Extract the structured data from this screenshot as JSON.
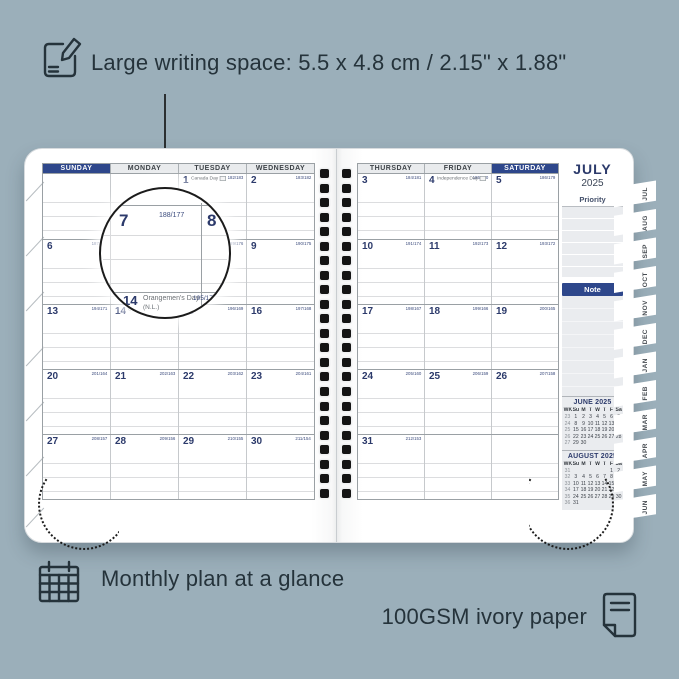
{
  "annotations": {
    "writing_space": {
      "icon": "pencil-note-icon",
      "text": "Large writing space: 5.5 x 4.8 cm / 2.15\" x 1.88\""
    },
    "monthly_plan": {
      "icon": "calendar-grid-icon",
      "text": "Monthly plan at a glance"
    },
    "paper": {
      "icon": "paper-sheet-icon",
      "text": "100GSM ivory paper"
    }
  },
  "colors": {
    "background": "#9BAFBA",
    "navy_accent": "#2E478B",
    "date_number": "#2C3A6B",
    "page": "#FFFFFF",
    "panel_gray": "#EAECEF",
    "ink": "#25333B"
  },
  "planner": {
    "left_page": {
      "day_headers": [
        {
          "label": "SUNDAY",
          "highlight": true
        },
        {
          "label": "MONDAY"
        },
        {
          "label": "TUESDAY"
        },
        {
          "label": "WEDNESDAY"
        }
      ],
      "weeks": [
        [
          {},
          {},
          {
            "date": "1",
            "counter": "182/183",
            "holiday": "Canada Day",
            "flag": true
          },
          {
            "date": "2",
            "counter": "183/182"
          }
        ],
        [
          {
            "date": "6",
            "counter": "187/178"
          },
          {
            "date": "7",
            "counter": "188/177"
          },
          {
            "date": "8",
            "counter": "189/176"
          },
          {
            "date": "9",
            "counter": "190/175"
          }
        ],
        [
          {
            "date": "13",
            "counter": "194/171"
          },
          {
            "date": "14",
            "counter": "195/170",
            "holiday": "Orangemen's Day (N.L.)",
            "flag": true
          },
          {
            "date": "15",
            "counter": "196/169"
          },
          {
            "date": "16",
            "counter": "197/168"
          }
        ],
        [
          {
            "date": "20",
            "counter": "201/164"
          },
          {
            "date": "21",
            "counter": "202/163"
          },
          {
            "date": "22",
            "counter": "203/162"
          },
          {
            "date": "23",
            "counter": "204/161"
          }
        ],
        [
          {
            "date": "27",
            "counter": "208/157"
          },
          {
            "date": "28",
            "counter": "209/156"
          },
          {
            "date": "29",
            "counter": "210/155"
          },
          {
            "date": "30",
            "counter": "211/154"
          }
        ]
      ]
    },
    "right_page": {
      "day_headers": [
        {
          "label": "THURSDAY"
        },
        {
          "label": "FRIDAY"
        },
        {
          "label": "SATURDAY",
          "highlight": true
        }
      ],
      "weeks": [
        [
          {
            "date": "3",
            "counter": "184/181"
          },
          {
            "date": "4",
            "counter": "185/180",
            "holiday": "Independence Day",
            "flag": true
          },
          {
            "date": "5",
            "counter": "186/179"
          }
        ],
        [
          {
            "date": "10",
            "counter": "191/174"
          },
          {
            "date": "11",
            "counter": "192/173"
          },
          {
            "date": "12",
            "counter": "193/172"
          }
        ],
        [
          {
            "date": "17",
            "counter": "198/167"
          },
          {
            "date": "18",
            "counter": "199/166"
          },
          {
            "date": "19",
            "counter": "200/165"
          }
        ],
        [
          {
            "date": "24",
            "counter": "205/160"
          },
          {
            "date": "25",
            "counter": "206/159"
          },
          {
            "date": "26",
            "counter": "207/158"
          }
        ],
        [
          {
            "date": "31",
            "counter": "212/153"
          },
          {},
          {}
        ]
      ]
    },
    "sidebar": {
      "month": "JULY",
      "year": "2025",
      "priority_label": "Priority",
      "note_label": "Note",
      "mini_calendars": [
        {
          "title": "JUNE 2025",
          "col_headers": [
            "WK",
            "Su",
            "M",
            "T",
            "W",
            "T",
            "F",
            "Sa"
          ],
          "weeks": [
            [
              "23",
              "1",
              "2",
              "3",
              "4",
              "5",
              "6",
              "7"
            ],
            [
              "24",
              "8",
              "9",
              "10",
              "11",
              "12",
              "13",
              "14"
            ],
            [
              "25",
              "15",
              "16",
              "17",
              "18",
              "19",
              "20",
              "21"
            ],
            [
              "26",
              "22",
              "23",
              "24",
              "25",
              "26",
              "27",
              "28"
            ],
            [
              "27",
              "29",
              "30",
              "",
              "",
              "",
              "",
              ""
            ]
          ]
        },
        {
          "title": "AUGUST 2025",
          "col_headers": [
            "WK",
            "Su",
            "M",
            "T",
            "W",
            "T",
            "F",
            "Sa"
          ],
          "weeks": [
            [
              "31",
              "",
              "",
              "",
              "",
              "",
              "1",
              "2"
            ],
            [
              "32",
              "3",
              "4",
              "5",
              "6",
              "7",
              "8",
              "9"
            ],
            [
              "33",
              "10",
              "11",
              "12",
              "13",
              "14",
              "15",
              "16"
            ],
            [
              "34",
              "17",
              "18",
              "19",
              "20",
              "21",
              "22",
              "23"
            ],
            [
              "35",
              "24",
              "25",
              "26",
              "27",
              "28",
              "29",
              "30"
            ],
            [
              "36",
              "31",
              "",
              "",
              "",
              "",
              "",
              ""
            ]
          ]
        }
      ]
    },
    "tabs": [
      "JUL",
      "AUG",
      "SEP",
      "OCT",
      "NOV",
      "DEC",
      "JAN",
      "FEB",
      "MAR",
      "APR",
      "MAY",
      "JUN"
    ]
  },
  "magnifier": {
    "day": "7",
    "counter": "188/177",
    "adjacent_day": "8",
    "bottom_date": "14",
    "bottom_holiday": "Orangemen's Day",
    "bottom_holiday_note": "(N.L.)",
    "bottom_counter": "195/170"
  }
}
